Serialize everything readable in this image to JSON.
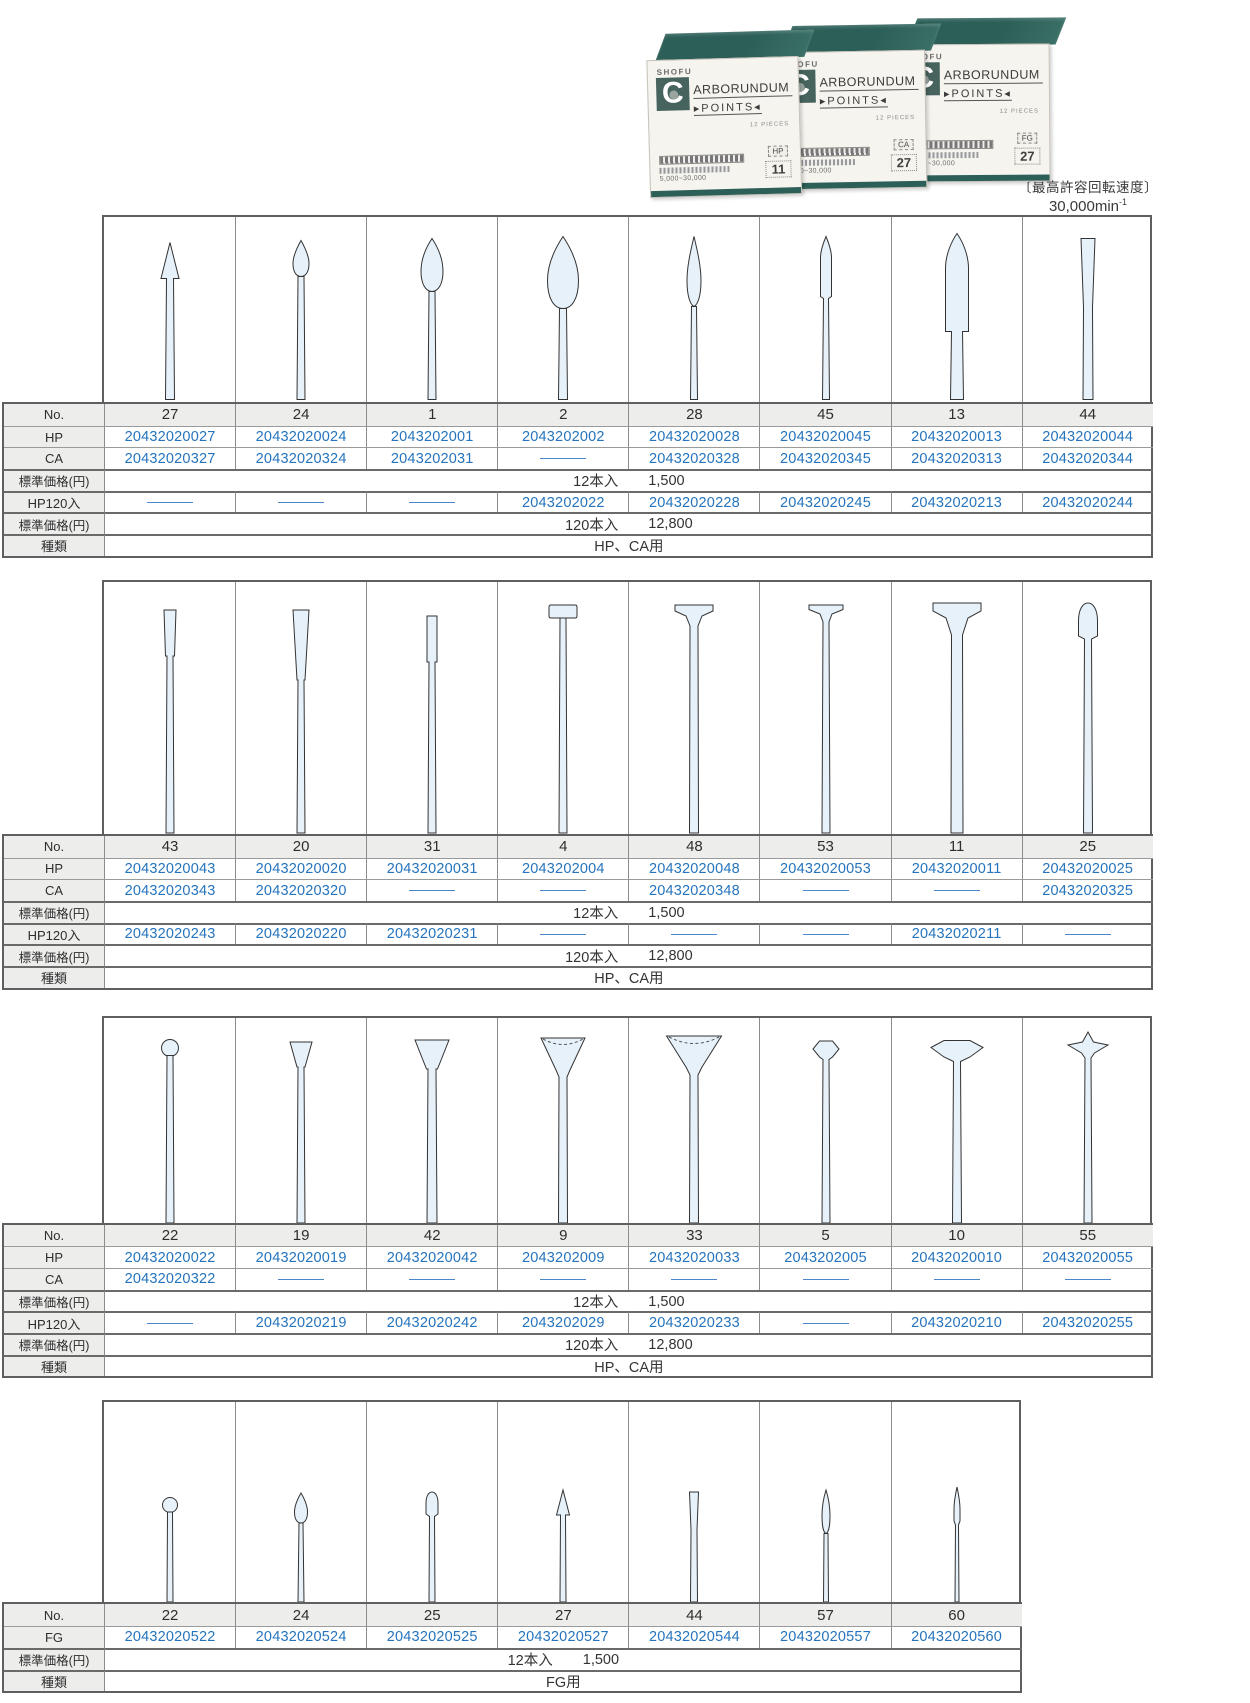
{
  "photo": {
    "brand": "SHOFU",
    "logo_letter": "C",
    "product_name_rest": "ARBORUNDUM",
    "product_sub": "▸POINTS◂",
    "pieces": "12 PIECES",
    "speed_range": "5,000~30,000",
    "boxes": [
      {
        "type": "HP",
        "number": "11"
      },
      {
        "type": "CA",
        "number": "27"
      },
      {
        "type": "FG",
        "number": "27"
      }
    ]
  },
  "speed_note": {
    "label": "〔最高許容回転速度〕",
    "value": "30,000min",
    "sup": "-1"
  },
  "labels": {
    "no": "No.",
    "hp": "HP",
    "ca": "CA",
    "fg": "FG",
    "price": "標準価格(円)",
    "hp120": "HP120入",
    "type": "種類"
  },
  "colors": {
    "code_blue": "#2574bd",
    "teal": "#2c5f58",
    "bur_fill": "#e7f1fa"
  },
  "tables": [
    {
      "id": 1,
      "price12_qty": "12本入",
      "price12_value": "1,500",
      "price120_qty": "120本入",
      "price120_value": "12,800",
      "type_value": "HP、CA用",
      "columns": [
        {
          "no": "27",
          "shape": "cone-point",
          "hp": "20432020027",
          "ca": "20432020327",
          "hp120": ""
        },
        {
          "no": "24",
          "shape": "bud-small",
          "hp": "20432020024",
          "ca": "20432020324",
          "hp120": ""
        },
        {
          "no": "1",
          "shape": "bud",
          "hp": "2043202001",
          "ca": "2043202031",
          "hp120": ""
        },
        {
          "no": "2",
          "shape": "bud-large",
          "hp": "2043202002",
          "ca": "",
          "hp120": "2043202022"
        },
        {
          "no": "28",
          "shape": "flame-slender",
          "hp": "20432020028",
          "ca": "20432020328",
          "hp120": "20432020228"
        },
        {
          "no": "45",
          "shape": "cylinder-point",
          "hp": "20432020045",
          "ca": "20432020345",
          "hp120": "20432020245"
        },
        {
          "no": "13",
          "shape": "torpedo",
          "hp": "20432020013",
          "ca": "20432020313",
          "hp120": "20432020213"
        },
        {
          "no": "44",
          "shape": "taper-flat",
          "hp": "20432020044",
          "ca": "20432020344",
          "hp120": "20432020244"
        }
      ]
    },
    {
      "id": 2,
      "price12_qty": "12本入",
      "price12_value": "1,500",
      "price120_qty": "120本入",
      "price120_value": "12,800",
      "type_value": "HP、CA用",
      "columns": [
        {
          "no": "43",
          "shape": "taper-small",
          "hp": "20432020043",
          "ca": "20432020343",
          "hp120": "20432020243"
        },
        {
          "no": "20",
          "shape": "taper-cone",
          "hp": "20432020020",
          "ca": "20432020320",
          "hp120": "20432020220"
        },
        {
          "no": "31",
          "shape": "cylinder-small",
          "hp": "20432020031",
          "ca": "",
          "hp120": "20432020231"
        },
        {
          "no": "4",
          "shape": "tee-small",
          "hp": "2043202004",
          "ca": "",
          "hp120": ""
        },
        {
          "no": "48",
          "shape": "tee-medium",
          "hp": "20432020048",
          "ca": "20432020348",
          "hp120": ""
        },
        {
          "no": "53",
          "shape": "tee-wide",
          "hp": "20432020053",
          "ca": "",
          "hp120": ""
        },
        {
          "no": "11",
          "shape": "tee-large",
          "hp": "20432020011",
          "ca": "",
          "hp120": "20432020211"
        },
        {
          "no": "25",
          "shape": "dome",
          "hp": "20432020025",
          "ca": "20432020325",
          "hp120": ""
        }
      ]
    },
    {
      "id": 3,
      "price12_qty": "12本入",
      "price12_value": "1,500",
      "price120_qty": "120本入",
      "price120_value": "12,800",
      "type_value": "HP、CA用",
      "columns": [
        {
          "no": "22",
          "shape": "ball",
          "hp": "20432020022",
          "ca": "20432020322",
          "hp120": ""
        },
        {
          "no": "19",
          "shape": "invcone-small",
          "hp": "20432020019",
          "ca": "",
          "hp120": "20432020219"
        },
        {
          "no": "42",
          "shape": "invcone",
          "hp": "20432020042",
          "ca": "",
          "hp120": "20432020242"
        },
        {
          "no": "9",
          "shape": "cup",
          "hp": "2043202009",
          "ca": "",
          "hp120": "2043202029"
        },
        {
          "no": "33",
          "shape": "cup-wide",
          "hp": "20432020033",
          "ca": "",
          "hp120": "20432020233"
        },
        {
          "no": "5",
          "shape": "wheel-knife",
          "hp": "2043202005",
          "ca": "",
          "hp120": ""
        },
        {
          "no": "10",
          "shape": "wheel-wide",
          "hp": "20432020010",
          "ca": "",
          "hp120": "20432020210"
        },
        {
          "no": "55",
          "shape": "wheel-point",
          "hp": "20432020055",
          "ca": "",
          "hp120": "20432020255"
        }
      ]
    },
    {
      "id": 4,
      "fg_table": true,
      "price12_qty": "12本入",
      "price12_value": "1,500",
      "type_value": "FG用",
      "columns": [
        {
          "no": "22",
          "shape": "ball-tiny",
          "fg": "20432020522"
        },
        {
          "no": "24",
          "shape": "bud-tiny",
          "fg": "20432020524"
        },
        {
          "no": "25",
          "shape": "dome-tiny",
          "fg": "20432020525"
        },
        {
          "no": "27",
          "shape": "cone-tiny",
          "fg": "20432020527"
        },
        {
          "no": "44",
          "shape": "taper-tiny",
          "fg": "20432020544"
        },
        {
          "no": "57",
          "shape": "flame-tiny",
          "fg": "20432020557"
        },
        {
          "no": "60",
          "shape": "point-tiny",
          "fg": "20432020560"
        }
      ]
    }
  ]
}
